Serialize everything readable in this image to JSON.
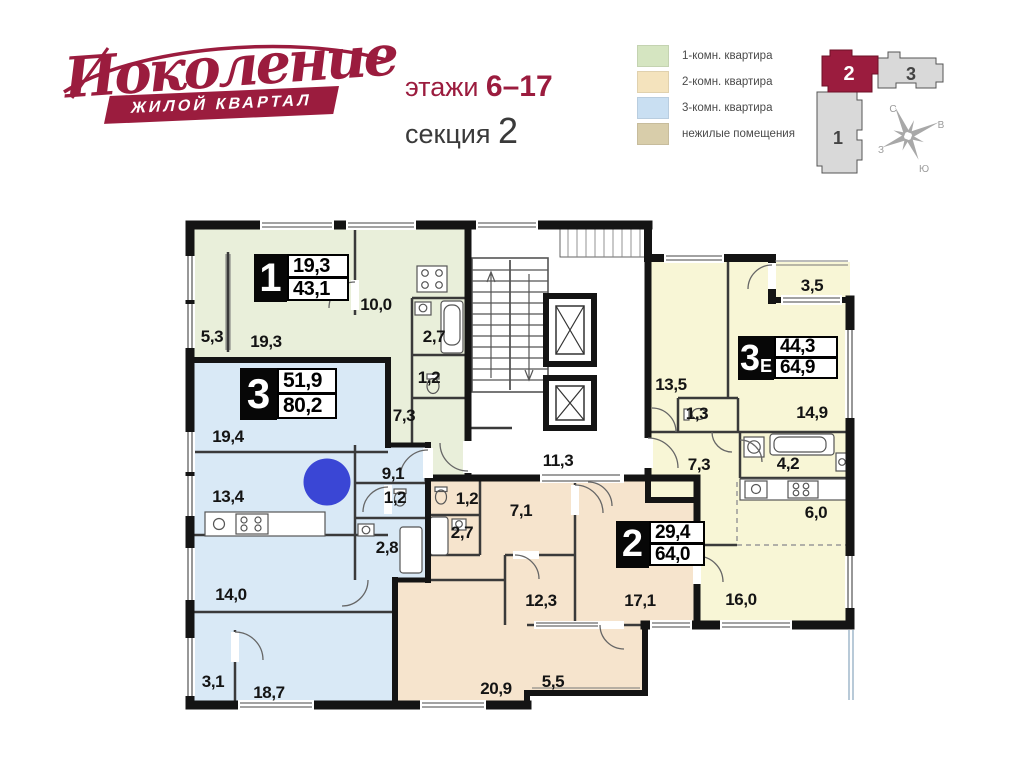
{
  "brand": {
    "name": "Поколение",
    "tagline": "ЖИЛОЙ КВАРТАЛ",
    "color": "#9b1c3e"
  },
  "header": {
    "floors_label": "этажи",
    "floors_value": "6–17",
    "section_label": "секция",
    "section_value": "2"
  },
  "legend": {
    "items": [
      {
        "label": "1-комн. квартира",
        "color": "#d5e5c1"
      },
      {
        "label": "2-комн. квартира",
        "color": "#f4e3bd"
      },
      {
        "label": "3-комн. квартира",
        "color": "#c9dff2"
      },
      {
        "label": "нежилые помещения",
        "color": "#d8cdaa"
      }
    ]
  },
  "minimap": {
    "sections": {
      "s1": "1",
      "s2": "2",
      "s3": "3"
    },
    "active_color": "#9b1c3e",
    "inactive_color": "#d9d9d9",
    "compass": {
      "n": "С",
      "e": "В",
      "s": "Ю",
      "w": "З"
    }
  },
  "plan": {
    "colors": {
      "apt1": "#e9efda",
      "apt2": "#f6e4cd",
      "apt3": "#d9e9f6",
      "apt3e": "#f8f6d6",
      "marker": "#3a46d5"
    },
    "apartments": [
      {
        "number": "1",
        "suffix": "",
        "area_top": "19,3",
        "area_bottom": "43,1"
      },
      {
        "number": "3",
        "suffix": "",
        "area_top": "51,9",
        "area_bottom": "80,2"
      },
      {
        "number": "3",
        "suffix": "Е",
        "area_top": "44,3",
        "area_bottom": "64,9"
      },
      {
        "number": "2",
        "suffix": "",
        "area_top": "29,4",
        "area_bottom": "64,0"
      }
    ],
    "rooms": {
      "apt1_53": "5,3",
      "apt1_193": "19,3",
      "apt1_100": "10,0",
      "apt1_27": "2,7",
      "apt1_12": "1,2",
      "apt1_73": "7,3",
      "apt3_194": "19,4",
      "apt3_134": "13,4",
      "apt3_91": "9,1",
      "apt3_12": "1,2",
      "apt3_28": "2,8",
      "apt3_140": "14,0",
      "apt3_31": "3,1",
      "apt3_187": "18,7",
      "core_113": "11,3",
      "apt2_12": "1,2",
      "apt2_71": "7,1",
      "apt2_27": "2,7",
      "apt2_123": "12,3",
      "apt2_171": "17,1",
      "apt2_209": "20,9",
      "apt2_55": "5,5",
      "e3_35": "3,5",
      "e3_135": "13,5",
      "e3_13": "1,3",
      "e3_73": "7,3",
      "e3_149": "14,9",
      "e3_42": "4,2",
      "e3_60": "6,0",
      "e3_160": "16,0"
    }
  }
}
